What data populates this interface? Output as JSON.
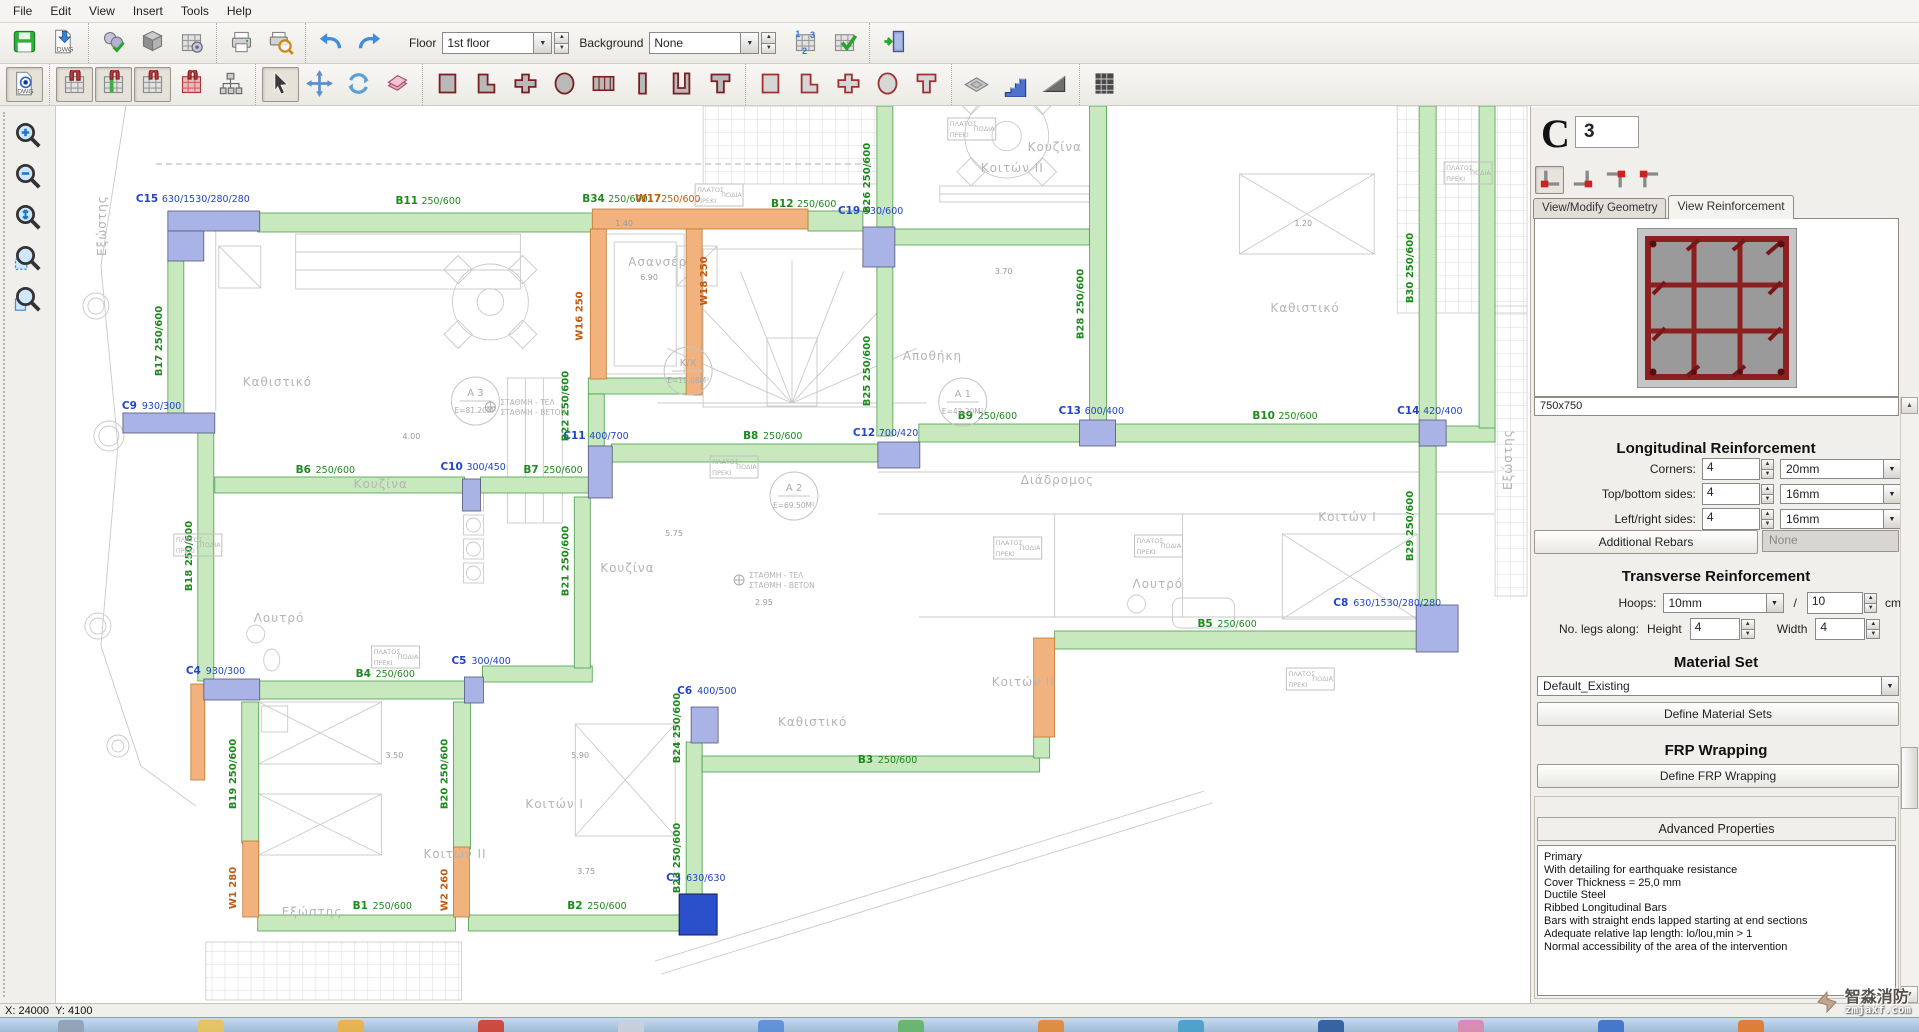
{
  "menu": {
    "items": [
      "File",
      "Edit",
      "View",
      "Insert",
      "Tools",
      "Help"
    ]
  },
  "toolbar_main": {
    "groups": [
      [
        "save-icon",
        "dwg-import-icon"
      ],
      [
        "settings-icon",
        "cube-icon",
        "grid-settings-icon"
      ],
      [
        "print-icon",
        "print-preview-icon"
      ],
      [
        "undo-icon",
        "redo-icon"
      ]
    ],
    "floor_label": "Floor",
    "floor_value": "1st floor",
    "background_label": "Background",
    "background_value": "None",
    "groups2": [
      [
        "renumber-grid-icon",
        "check-model-icon"
      ],
      [
        "exit-icon"
      ]
    ]
  },
  "toolbar_draw": {
    "groups": [
      [
        "dwg-view-icon"
      ],
      [
        "model-snap-icon",
        "model-grid-green-icon",
        "model-grid-icon",
        "model-grid-red-icon",
        "model-tree-icon"
      ],
      [
        "select-icon",
        "move-icon",
        "rotate-icon",
        "delete-icon"
      ],
      [
        "section-rect-icon",
        "section-l-icon",
        "section-plus-icon",
        "section-circle-icon",
        "section-composite-icon",
        "section-wall-icon",
        "section-u-icon",
        "section-tee-icon"
      ],
      [
        "member-rect-icon",
        "member-l-icon",
        "member-plus-icon",
        "member-circle-icon",
        "member-tee-icon"
      ],
      [
        "slab-icon",
        "stairs-icon",
        "ramp-icon"
      ],
      [
        "render3d-icon"
      ]
    ],
    "pressed": [
      "dwg-view-icon",
      "model-snap-icon",
      "model-grid-green-icon",
      "model-grid-icon",
      "select-icon"
    ]
  },
  "left_tools": {
    "items": [
      "zoom-in-icon",
      "zoom-out-icon",
      "zoom-extents-icon",
      "zoom-window-icon",
      "zoom-previous-icon"
    ]
  },
  "panel": {
    "type_letter": "C",
    "number_value": "3",
    "position_icons": [
      "column-pos-bl-icon",
      "column-pos-br-icon",
      "column-pos-tr-icon",
      "column-pos-tl-icon"
    ],
    "position_pressed": "column-pos-bl-icon",
    "tabs": [
      {
        "label": "View/Modify Geometry",
        "active": false
      },
      {
        "label": "View Reinforcement",
        "active": true
      }
    ],
    "section_size": "750x750",
    "longitudinal": {
      "title": "Longitudinal Reinforcement",
      "rows": [
        {
          "label": "Corners:",
          "count": "4",
          "diameter": "20mm"
        },
        {
          "label": "Top/bottom sides:",
          "count": "4",
          "diameter": "16mm"
        },
        {
          "label": "Left/right sides:",
          "count": "4",
          "diameter": "16mm"
        }
      ],
      "additional_button": "Additional Rebars",
      "additional_value": "None"
    },
    "transverse": {
      "title": "Transverse Reinforcement",
      "hoops_label": "Hoops:",
      "hoops_diameter": "10mm",
      "separator": "/",
      "spacing": "10",
      "spacing_unit": "cm",
      "legs_label": "No. legs along:",
      "height_label": "Height",
      "height_value": "4",
      "width_label": "Width",
      "width_value": "4"
    },
    "material": {
      "title": "Material Set",
      "value": "Default_Existing",
      "button": "Define Material Sets"
    },
    "frp": {
      "title": "FRP Wrapping",
      "button": "Define FRP Wrapping"
    },
    "advanced": {
      "title": "Advanced Properties",
      "lines": [
        "Primary",
        "With detailing for earthquake resistance",
        "Cover Thickness = 25,0 mm",
        "Ductile Steel",
        "Ribbed Longitudinal Bars",
        "Bars with straight ends lapped starting at end sections",
        "Adequate relative lap length: lo/lou,min > 1",
        "Normal accessibility of the area of the intervention"
      ]
    }
  },
  "statusbar": {
    "x": "X: 24000",
    "y": "Y: 4100"
  },
  "watermark": {
    "cn": "智淼消防",
    "en": "zmjaxf.com"
  },
  "taskbar": {
    "icon_colors": [
      "#8fa2b5",
      "#e6c35c",
      "#e9b24a",
      "#cc4438",
      "#c8d0da",
      "#5f8fd6",
      "#66b36a",
      "#e08a3a",
      "#4aa0c8",
      "#2f5f9e",
      "#d98ab0",
      "#3f74c8",
      "#e07a30"
    ]
  },
  "colors": {
    "beam_green_fill": "#c7e9bd",
    "beam_green_line": "#4a9e4a",
    "beam_label": "#1e8a1e",
    "column_blue_fill": "#a9b3e6",
    "column_blue_line": "#55567a",
    "column_label": "#2244cc",
    "wall_orange_fill": "#f2b27e",
    "wall_orange_line": "#c07830",
    "wall_label": "#c05a10",
    "selected_fill": "#2b50cc",
    "gray": "#c9c9c9",
    "room_text": "#b5b5b5"
  },
  "plan": {
    "beams_green": [
      [
        202,
        107,
        339,
        19
      ],
      [
        753,
        105,
        55,
        20
      ],
      [
        822,
        0,
        16,
        125
      ],
      [
        822,
        160,
        16,
        170
      ],
      [
        838,
        123,
        197,
        16
      ],
      [
        556,
        338,
        267,
        18
      ],
      [
        533,
        272,
        114,
        16
      ],
      [
        533,
        288,
        16,
        52
      ],
      [
        159,
        371,
        250,
        16
      ],
      [
        425,
        371,
        110,
        16
      ],
      [
        112,
        153,
        16,
        158
      ],
      [
        142,
        326,
        16,
        249
      ],
      [
        864,
        318,
        163,
        18
      ],
      [
        1060,
        318,
        307,
        18
      ],
      [
        1392,
        320,
        49,
        16
      ],
      [
        1035,
        0,
        17,
        318
      ],
      [
        1365,
        0,
        17,
        316
      ],
      [
        1425,
        0,
        16,
        322
      ],
      [
        1365,
        340,
        17,
        160
      ],
      [
        1000,
        525,
        367,
        18
      ],
      [
        203,
        575,
        208,
        18
      ],
      [
        427,
        560,
        110,
        16
      ],
      [
        519,
        391,
        16,
        171
      ],
      [
        186,
        596,
        17,
        141
      ],
      [
        398,
        596,
        17,
        147
      ],
      [
        202,
        809,
        198,
        16
      ],
      [
        413,
        809,
        213,
        16
      ],
      [
        631,
        636,
        16,
        154
      ],
      [
        647,
        650,
        338,
        16
      ],
      [
        979,
        629,
        16,
        23
      ]
    ],
    "walls_orange": [
      [
        537,
        103,
        216,
        20
      ],
      [
        535,
        123,
        16,
        150
      ],
      [
        631,
        123,
        16,
        166
      ],
      [
        187,
        735,
        16,
        76
      ],
      [
        398,
        741,
        16,
        70
      ],
      [
        979,
        532,
        21,
        99
      ],
      [
        135,
        578,
        14,
        96
      ]
    ],
    "columns_blue": [
      [
        112,
        105,
        92,
        20
      ],
      [
        112,
        125,
        36,
        30
      ],
      [
        808,
        121,
        32,
        40
      ],
      [
        67,
        307,
        92,
        20
      ],
      [
        407,
        373,
        18,
        32
      ],
      [
        533,
        340,
        24,
        52
      ],
      [
        823,
        336,
        42,
        26
      ],
      [
        1025,
        314,
        36,
        26
      ],
      [
        1365,
        314,
        27,
        26
      ],
      [
        1362,
        499,
        42,
        47
      ],
      [
        148,
        573,
        56,
        21
      ],
      [
        409,
        571,
        19,
        26
      ],
      [
        636,
        601,
        27,
        36
      ]
    ],
    "selected_column": [
      624,
      788,
      38,
      41
    ],
    "labels": [
      {
        "t": "C15",
        "d": "630/1530/280/280",
        "x": 80,
        "y": 96,
        "c": "col"
      },
      {
        "t": "C19",
        "d": "530/600",
        "x": 783,
        "y": 108,
        "c": "col"
      },
      {
        "t": "C9",
        "d": "930/300",
        "x": 66,
        "y": 303,
        "c": "col"
      },
      {
        "t": "C10",
        "d": "300/450",
        "x": 385,
        "y": 364,
        "c": "col"
      },
      {
        "t": "C11",
        "d": "400/700",
        "x": 508,
        "y": 333,
        "c": "col"
      },
      {
        "t": "C12",
        "d": "700/420",
        "x": 798,
        "y": 330,
        "c": "col"
      },
      {
        "t": "C13",
        "d": "600/400",
        "x": 1004,
        "y": 308,
        "c": "col"
      },
      {
        "t": "C14",
        "d": "420/400",
        "x": 1343,
        "y": 308,
        "c": "col"
      },
      {
        "t": "C8",
        "d": "630/1530/280/280",
        "x": 1279,
        "y": 500,
        "c": "col"
      },
      {
        "t": "C4",
        "d": "930/300",
        "x": 130,
        "y": 568,
        "c": "col"
      },
      {
        "t": "C5",
        "d": "300/400",
        "x": 396,
        "y": 558,
        "c": "col"
      },
      {
        "t": "C6",
        "d": "400/500",
        "x": 622,
        "y": 588,
        "c": "col"
      },
      {
        "t": "C3",
        "d": "630/630",
        "x": 611,
        "y": 775,
        "c": "col"
      },
      {
        "t": "B11",
        "d": "250/600",
        "x": 340,
        "y": 98,
        "c": "beam"
      },
      {
        "t": "B34",
        "d": "250/600",
        "x": 527,
        "y": 96,
        "c": "beam"
      },
      {
        "t": "W17",
        "d": "250/600",
        "x": 580,
        "y": 96,
        "c": "wall"
      },
      {
        "t": "B12",
        "d": "250/600",
        "x": 716,
        "y": 101,
        "c": "beam"
      },
      {
        "t": "B6",
        "d": "250/600",
        "x": 240,
        "y": 367,
        "c": "beam"
      },
      {
        "t": "B7",
        "d": "250/600",
        "x": 468,
        "y": 367,
        "c": "beam"
      },
      {
        "t": "B8",
        "d": "250/600",
        "x": 688,
        "y": 333,
        "c": "beam"
      },
      {
        "t": "B9",
        "d": "250/600",
        "x": 903,
        "y": 313,
        "c": "beam"
      },
      {
        "t": "B10",
        "d": "250/600",
        "x": 1198,
        "y": 313,
        "c": "beam"
      },
      {
        "t": "B5",
        "d": "250/600",
        "x": 1143,
        "y": 521,
        "c": "beam"
      },
      {
        "t": "B4",
        "d": "250/600",
        "x": 300,
        "y": 571,
        "c": "beam"
      },
      {
        "t": "B3",
        "d": "250/600",
        "x": 803,
        "y": 657,
        "c": "beam"
      },
      {
        "t": "B1",
        "d": "250/600",
        "x": 297,
        "y": 803,
        "c": "beam"
      },
      {
        "t": "B2",
        "d": "250/600",
        "x": 512,
        "y": 803,
        "c": "beam"
      },
      {
        "t": "B17",
        "d": "250/600",
        "x": 106,
        "y": 235,
        "c": "beam",
        "v": true
      },
      {
        "t": "B18",
        "d": "250/600",
        "x": 136,
        "y": 450,
        "c": "beam",
        "v": true
      },
      {
        "t": "B26",
        "d": "250/600",
        "x": 815,
        "y": 72,
        "c": "beam",
        "v": true
      },
      {
        "t": "B25",
        "d": "250/600",
        "x": 815,
        "y": 265,
        "c": "beam",
        "v": true
      },
      {
        "t": "B28",
        "d": "250/600",
        "x": 1029,
        "y": 198,
        "c": "beam",
        "v": true
      },
      {
        "t": "B30",
        "d": "250/600",
        "x": 1359,
        "y": 162,
        "c": "beam",
        "v": true
      },
      {
        "t": "B29",
        "d": "250/600",
        "x": 1359,
        "y": 420,
        "c": "beam",
        "v": true
      },
      {
        "t": "B22",
        "d": "250/600",
        "x": 513,
        "y": 300,
        "c": "beam",
        "v": true
      },
      {
        "t": "B21",
        "d": "250/600",
        "x": 513,
        "y": 455,
        "c": "beam",
        "v": true
      },
      {
        "t": "B19",
        "d": "250/600",
        "x": 180,
        "y": 668,
        "c": "beam",
        "v": true
      },
      {
        "t": "B20",
        "d": "250/600",
        "x": 392,
        "y": 668,
        "c": "beam",
        "v": true
      },
      {
        "t": "B24",
        "d": "250/600",
        "x": 625,
        "y": 622,
        "c": "beam",
        "v": true
      },
      {
        "t": "B23",
        "d": "250/600",
        "x": 625,
        "y": 752,
        "c": "beam",
        "v": true
      },
      {
        "t": "W16",
        "d": "250",
        "x": 527,
        "y": 210,
        "c": "wall",
        "v": true
      },
      {
        "t": "W18",
        "d": "250",
        "x": 652,
        "y": 175,
        "c": "wall",
        "v": true
      },
      {
        "t": "W1",
        "d": "280",
        "x": 180,
        "y": 782,
        "c": "wall",
        "v": true
      },
      {
        "t": "W2",
        "d": "260",
        "x": 392,
        "y": 784,
        "c": "wall",
        "v": true
      }
    ],
    "rooms": [
      {
        "t": "Καθιστικό",
        "x": 187,
        "y": 280
      },
      {
        "t": "Καθιστικό",
        "x": 723,
        "y": 620
      },
      {
        "t": "Καθιστικό",
        "x": 1216,
        "y": 206
      },
      {
        "t": "Κουζίνα",
        "x": 298,
        "y": 382
      },
      {
        "t": "Κουζίνα",
        "x": 545,
        "y": 466
      },
      {
        "t": "Κουζίνα",
        "x": 973,
        "y": 45
      },
      {
        "t": "Κοιτών I",
        "x": 470,
        "y": 702
      },
      {
        "t": "Κοιτών I",
        "x": 1264,
        "y": 415
      },
      {
        "t": "Κοιτών II",
        "x": 368,
        "y": 752
      },
      {
        "t": "Κοιτών II",
        "x": 937,
        "y": 580
      },
      {
        "t": "Κοιτών II",
        "x": 926,
        "y": 66
      },
      {
        "t": "Λουτρό",
        "x": 198,
        "y": 516
      },
      {
        "t": "Λουτρό",
        "x": 1078,
        "y": 482
      },
      {
        "t": "Διάδρομος",
        "x": 966,
        "y": 378
      },
      {
        "t": "Ασανσέρ",
        "x": 573,
        "y": 160
      },
      {
        "t": "Αποθήκη",
        "x": 848,
        "y": 254
      },
      {
        "t": "Εξώστης",
        "x": 50,
        "y": 150,
        "v": true
      },
      {
        "t": "Εξώστης",
        "x": 226,
        "y": 810
      },
      {
        "t": "Εξώστης",
        "x": 1458,
        "y": 384,
        "v": true
      }
    ],
    "areas": [
      {
        "n": "A 3",
        "e": "E=81.20M²",
        "x": 420,
        "y": 295
      },
      {
        "n": "K/X",
        "e": "E=19.08M²",
        "x": 633,
        "y": 265
      },
      {
        "n": "A 1",
        "e": "E=42.20M²",
        "x": 908,
        "y": 296
      },
      {
        "n": "A 2",
        "e": "E=69.50M²",
        "x": 739,
        "y": 390
      }
    ],
    "notes": [
      {
        "l1": "ΣΤΑΘΜΗ - ΤΕΛ",
        "l2": "ΣΤΑΘΜΗ - ΒΕΤΟΝ",
        "x": 445,
        "y": 305
      },
      {
        "l1": "ΣΤΑΘΜΗ - ΤΕΛ",
        "l2": "ΣΤΑΘΜΗ - ΒΕΤΟΝ",
        "x": 694,
        "y": 478
      }
    ],
    "plats": [
      [
        640,
        78
      ],
      [
        893,
        12
      ],
      [
        1390,
        56
      ],
      [
        655,
        350
      ],
      [
        939,
        431
      ],
      [
        1080,
        429
      ],
      [
        1232,
        562
      ],
      [
        118,
        428
      ],
      [
        316,
        540
      ]
    ],
    "plat_text": {
      "l1": "ΠΛΑΤΟΣ",
      "l2": "ΠΡΕΚΙ",
      "l3": "ΠΟΔΙΑ"
    },
    "dims": [
      {
        "t": "6.90",
        "x": 585,
        "y": 174
      },
      {
        "t": "4.00",
        "x": 347,
        "y": 333
      },
      {
        "t": "5.75",
        "x": 610,
        "y": 430
      },
      {
        "t": "3.50",
        "x": 330,
        "y": 652
      },
      {
        "t": "5.90",
        "x": 516,
        "y": 652
      },
      {
        "t": "3.75",
        "x": 522,
        "y": 768
      },
      {
        "t": "2.95",
        "x": 700,
        "y": 499
      },
      {
        "t": "1.40",
        "x": 560,
        "y": 120
      },
      {
        "t": "3.70",
        "x": 940,
        "y": 168
      },
      {
        "t": "1.20",
        "x": 1240,
        "y": 120
      }
    ]
  }
}
